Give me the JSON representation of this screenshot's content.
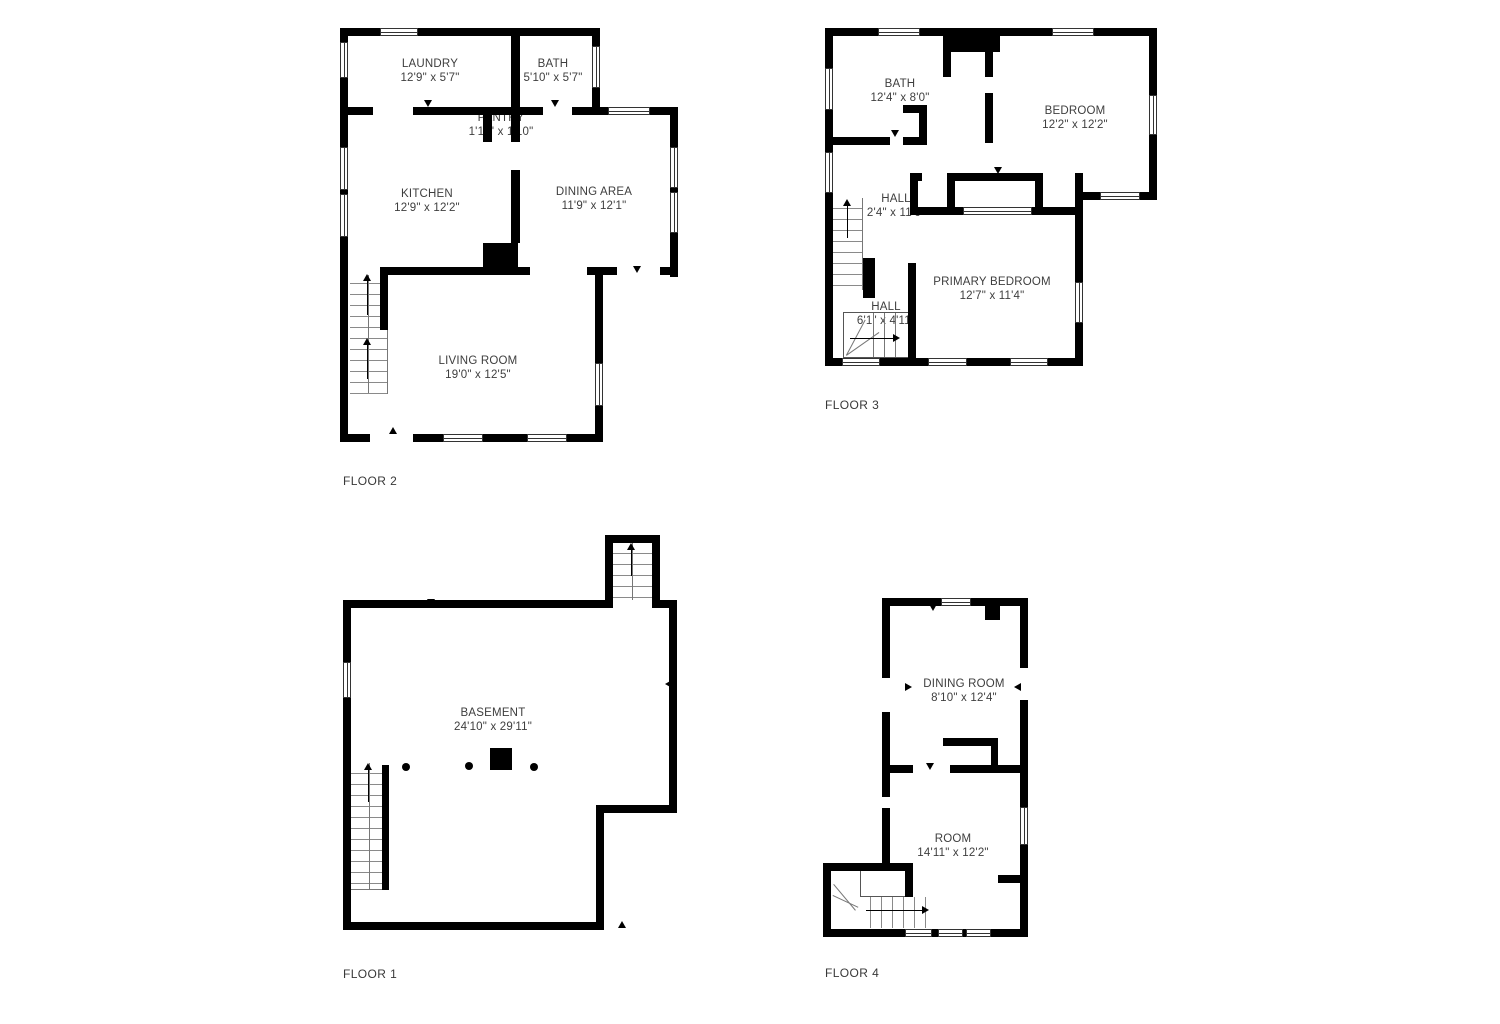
{
  "colors": {
    "wall": "#000000",
    "text": "#3e3e3e",
    "background": "#ffffff"
  },
  "floors": [
    {
      "id": "floor-2",
      "label": "FLOOR 2",
      "rooms": [
        {
          "key": "laundry",
          "name": "LAUNDRY",
          "dims": "12'9\" x 5'7\""
        },
        {
          "key": "bath",
          "name": "BATH",
          "dims": "5'10\" x 5'7\""
        },
        {
          "key": "pantry",
          "name": "PANTRY",
          "dims": "1'11\" x 1'10\""
        },
        {
          "key": "kitchen",
          "name": "KITCHEN",
          "dims": "12'9\" x 12'2\""
        },
        {
          "key": "dining-area",
          "name": "DINING AREA",
          "dims": "11'9\" x 12'1\""
        },
        {
          "key": "living-room",
          "name": "LIVING ROOM",
          "dims": "19'0\" x 12'5\""
        }
      ]
    },
    {
      "id": "floor-3",
      "label": "FLOOR 3",
      "rooms": [
        {
          "key": "bath",
          "name": "BATH",
          "dims": "12'4\" x 8'0\""
        },
        {
          "key": "bedroom",
          "name": "BEDROOM",
          "dims": "12'2\" x 12'2\""
        },
        {
          "key": "hall-upper",
          "name": "HALL",
          "dims": "2'4\" x 11'6\""
        },
        {
          "key": "primary-bedroom",
          "name": "PRIMARY BEDROOM",
          "dims": "12'7\" x 11'4\""
        },
        {
          "key": "hall-lower",
          "name": "HALL",
          "dims": "6'1\" x 4'11\""
        }
      ]
    },
    {
      "id": "floor-1",
      "label": "FLOOR 1",
      "rooms": [
        {
          "key": "basement",
          "name": "BASEMENT",
          "dims": "24'10\" x 29'11\""
        }
      ]
    },
    {
      "id": "floor-4",
      "label": "FLOOR 4",
      "rooms": [
        {
          "key": "dining-room",
          "name": "DINING ROOM",
          "dims": "8'10\" x 12'4\""
        },
        {
          "key": "room",
          "name": "ROOM",
          "dims": "14'11\" x 12'2\""
        }
      ]
    }
  ]
}
